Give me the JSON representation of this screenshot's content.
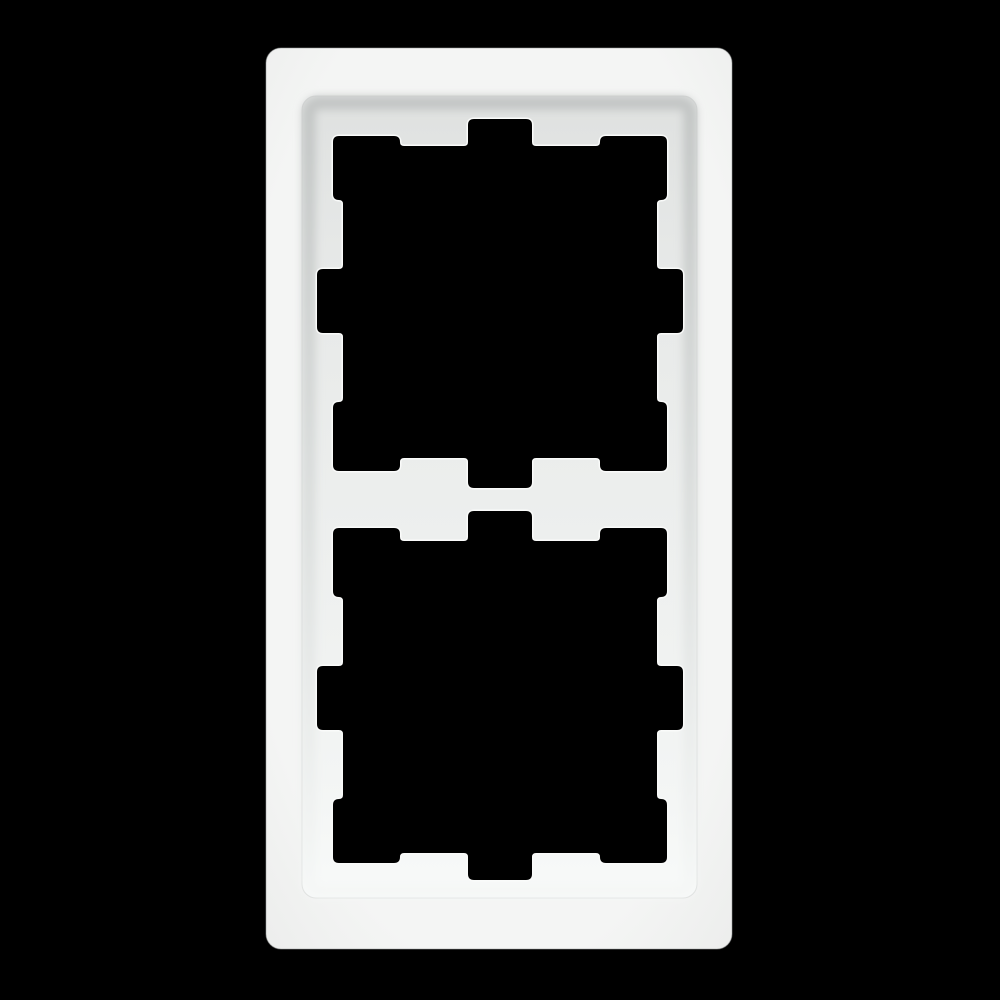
{
  "meta": {
    "description": "Product photo of a white plastic 2-gang (double) wall switch / socket cover frame, portrait orientation, centered on a pure black background",
    "object": "double-switch-cover-frame",
    "gangs": 2,
    "orientation": "vertical",
    "visible_text": ""
  },
  "colors": {
    "background": "#000000",
    "face_center": "#f4f5f4",
    "face_edge": "#edeeed",
    "face_outline": "#9a9d9c",
    "face_inner_edge_line": "#cfd2d1",
    "floor_top": "#dfe1e0",
    "floor_upper_mid": "#e7e9e8",
    "floor_mid": "#edefee",
    "floor_lower": "#f3f5f4",
    "floor_bottom": "#f8faf9",
    "bevel_shadow_top": "#c2c5c4",
    "bevel_shadow_mid": "#d8dbda",
    "bevel_light_bottom": "#f5f7f6",
    "cut_edge_highlight": "#fafbfa",
    "opening": "#000000"
  },
  "geometry": {
    "canvas": {
      "w": 1000,
      "h": 1000
    },
    "outer": {
      "x": 266,
      "y": 48,
      "w": 466,
      "h": 901,
      "r": 15
    },
    "recess": {
      "x": 302,
      "y": 96,
      "w": 395,
      "h": 802,
      "r": 14
    },
    "bevel_ring": {
      "x": 309,
      "y": 103,
      "w": 381,
      "h": 788,
      "r": 10,
      "stroke_width": 13
    },
    "corner_radius": 5,
    "highlight_stroke_width": 5,
    "cut_stroke_width": 2,
    "mirror_sum_y": 999,
    "opening_upper": [
      [
        334,
        137
      ],
      [
        399,
        137
      ],
      [
        399,
        147
      ],
      [
        469,
        147
      ],
      [
        469,
        120
      ],
      [
        531,
        120
      ],
      [
        531,
        147
      ],
      [
        601,
        147
      ],
      [
        601,
        137
      ],
      [
        666,
        137
      ],
      [
        666,
        199
      ],
      [
        656,
        199
      ],
      [
        656,
        270
      ],
      [
        682,
        270
      ],
      [
        682,
        332
      ],
      [
        656,
        332
      ],
      [
        656,
        403
      ],
      [
        666,
        403
      ],
      [
        666,
        470
      ],
      [
        601,
        470
      ],
      [
        601,
        457
      ],
      [
        531,
        457
      ],
      [
        531,
        487
      ],
      [
        469,
        487
      ],
      [
        469,
        457
      ],
      [
        399,
        457
      ],
      [
        399,
        470
      ],
      [
        334,
        470
      ],
      [
        334,
        403
      ],
      [
        344,
        403
      ],
      [
        344,
        332
      ],
      [
        318,
        332
      ],
      [
        318,
        270
      ],
      [
        344,
        270
      ],
      [
        344,
        199
      ],
      [
        334,
        199
      ]
    ]
  }
}
